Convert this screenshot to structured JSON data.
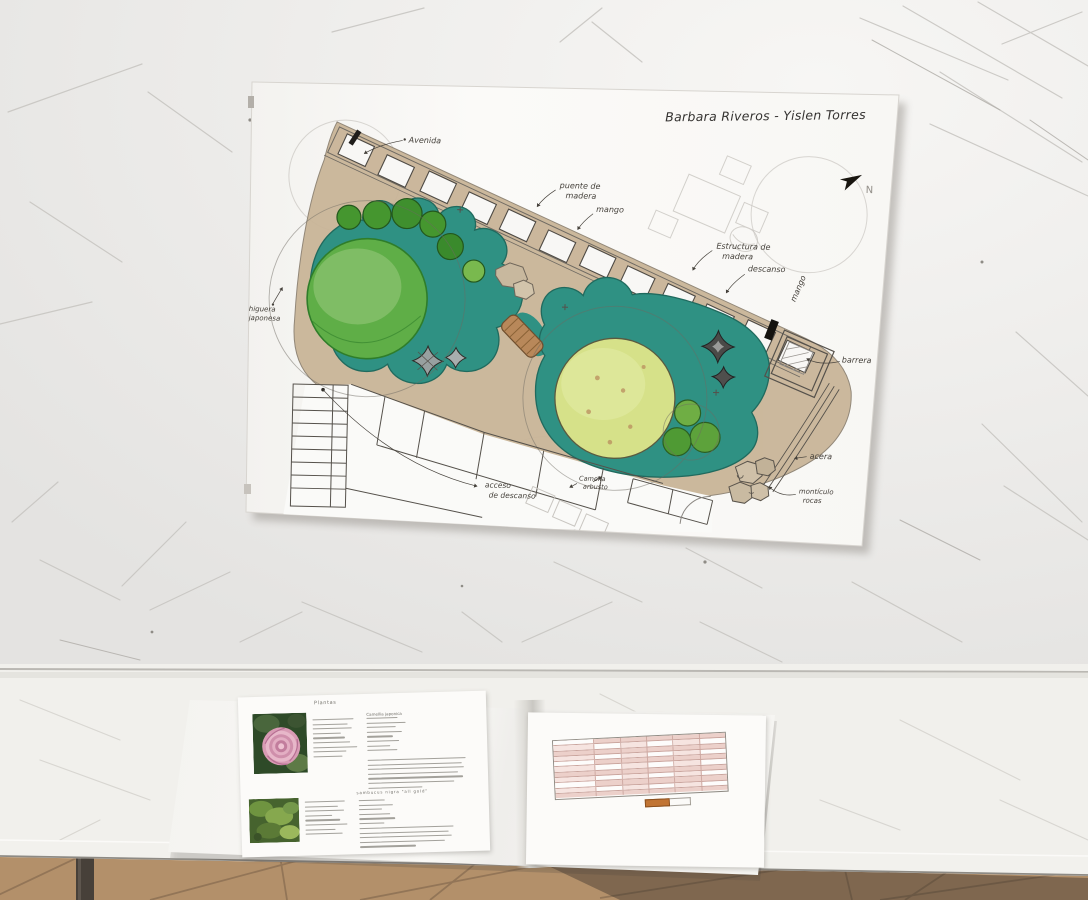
{
  "scene": {
    "setting": "photo of a hand-drawn landscape garden plan taped to a scratched white wall, with plant datasheets and a printed table in an open folder on a white table above a tiled floor"
  },
  "plan": {
    "title": "Barbara Riveros - Yislen Torres",
    "compass": "N",
    "labels": {
      "avenida": "Avenida",
      "puente_l1": "puente de",
      "puente_l2": "madera",
      "mango_top": "mango",
      "estructura_l1": "Estructura de",
      "estructura_l2": "madera",
      "descanso": "descanso",
      "mango_side": "mango",
      "barrera": "barrera",
      "acera": "acera",
      "monticulo_l1": "montículo",
      "monticulo_l2": "rocas",
      "higuera_l1": "higuera",
      "higuera_l2": "japonesa",
      "acceso_l1": "acceso",
      "acceso_l2": "de descanso",
      "camelia_l1": "Camelia",
      "camelia_l2": "arbusto"
    }
  },
  "documents": {
    "left_sheet": {
      "heading": "Plantas",
      "plant1_name": "Camellia japonica",
      "plant2_name": "sambucus nigra \"all gold\"",
      "photo1": "pink camellia flower",
      "photo2": "golden green foliage"
    },
    "right_sheet": {
      "description": "printed table with pink header rows, white data rows and an orange highlighted total cell"
    }
  },
  "colors": {
    "pond_teal": "#2f9183",
    "canopy_green": "#5fae47",
    "canopy_yellow_green": "#d6e189",
    "ground_tan": "#c9b598",
    "bridge_brown": "#b8885a",
    "table_header_pink": "#ecd0ca",
    "total_cell_orange": "#c17434"
  }
}
